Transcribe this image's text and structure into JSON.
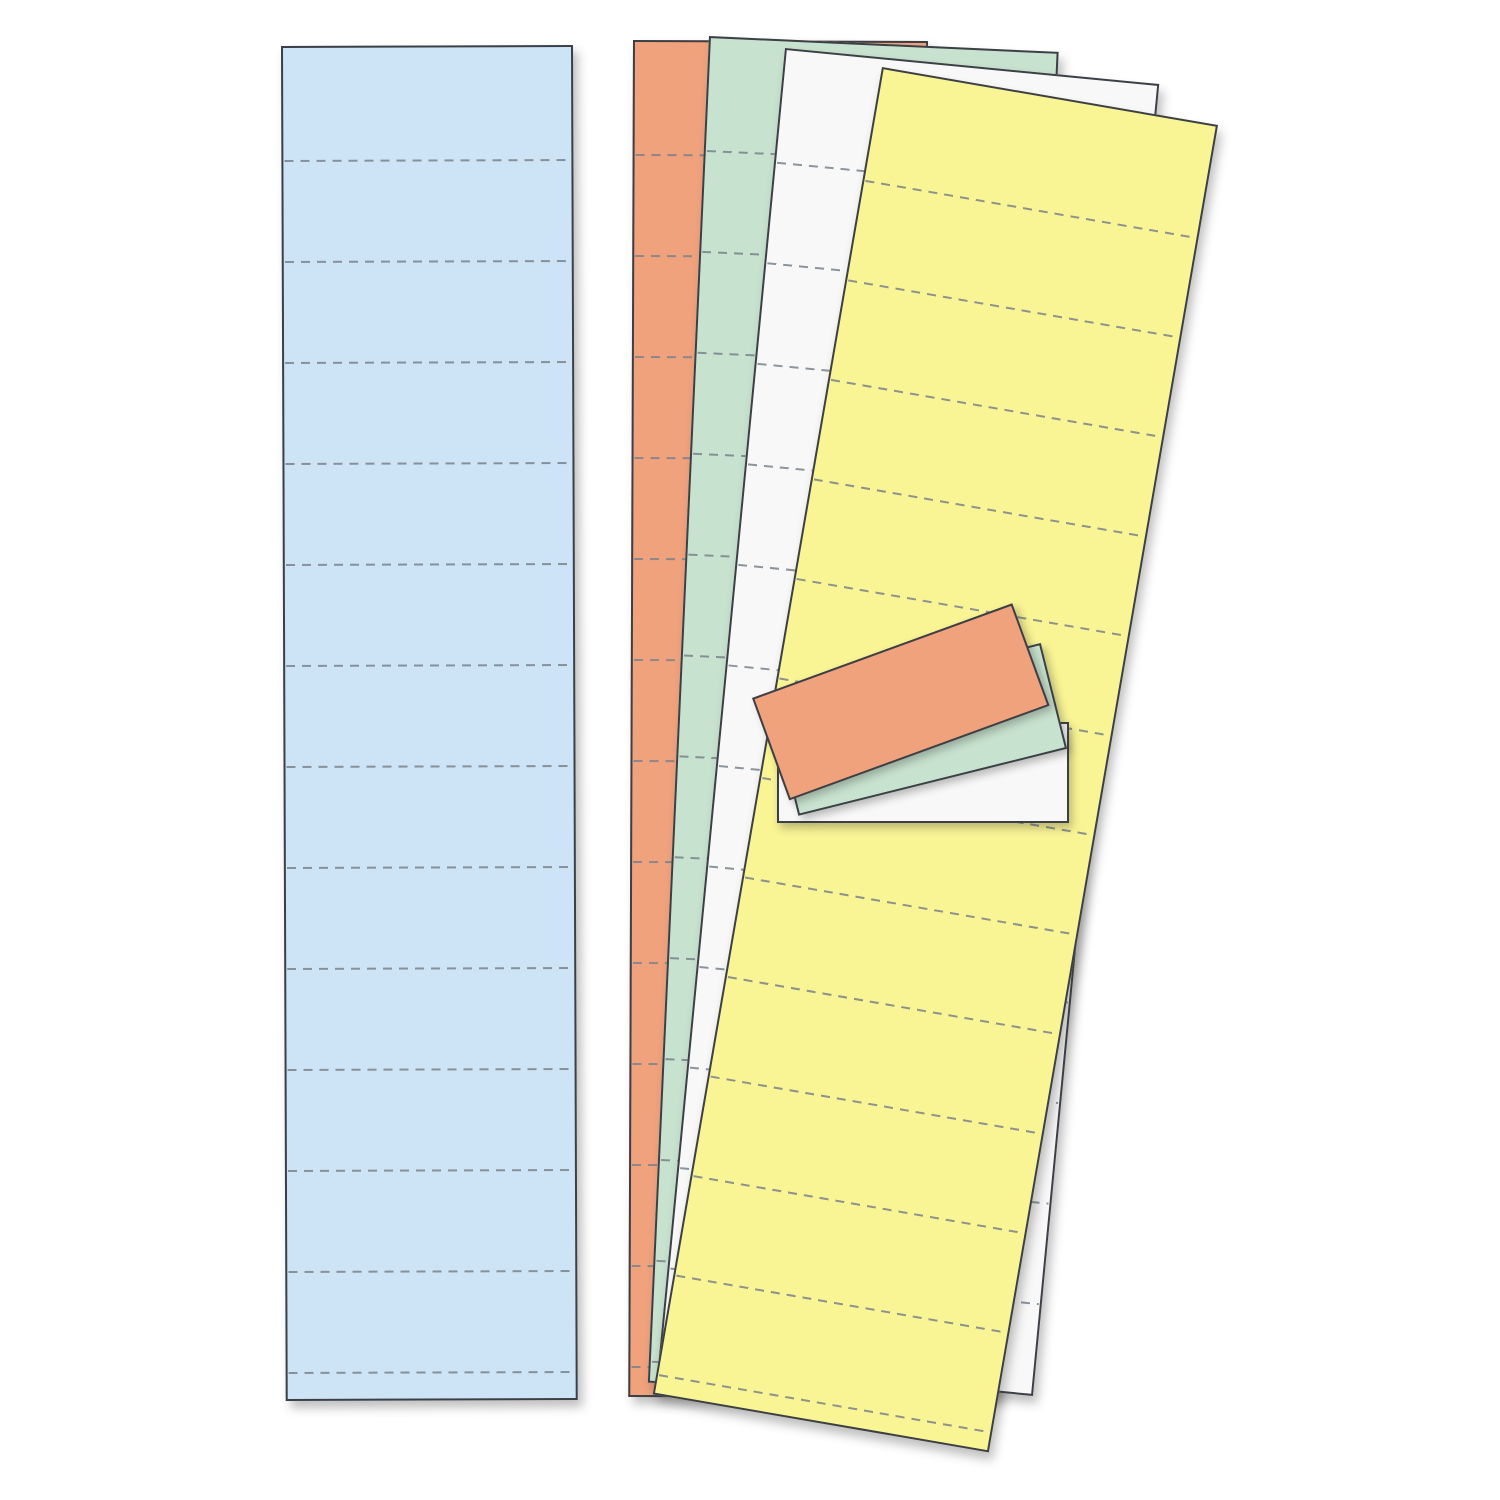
{
  "scene": {
    "type": "product-photo",
    "subject": "Blank perforated data card refill strips in five pastel colors",
    "background_color": "#ffffff",
    "border_color": "#3c4046",
    "perforation_color": "#79828c",
    "perforation_dash_px": 9,
    "perforation_gap_px": 7,
    "strip_shadow": "5px 7px 10px rgba(45,45,45,0.30)",
    "card_shadow": "3px 5px 8px rgba(45,45,45,0.30)"
  },
  "strips": [
    {
      "id": "blue-strip",
      "color_name": "blue",
      "fill": "#cce4f6",
      "x": 281,
      "y": 46,
      "width": 292,
      "height": 1355,
      "rotation": -0.2,
      "perf_offset": 113,
      "perf_spacing": 101
    },
    {
      "id": "salmon-sheet",
      "color_name": "salmon",
      "fill": "#f0a27d",
      "x": 633,
      "y": 40,
      "width": 295,
      "height": 1357,
      "rotation": 0.2,
      "perf_offset": 113,
      "perf_spacing": 101
    },
    {
      "id": "green-sheet",
      "color_name": "green",
      "fill": "#c7e2ce",
      "x": 709,
      "y": 36,
      "width": 350,
      "height": 1348,
      "rotation": 2.6,
      "perf_offset": 113,
      "perf_spacing": 101
    },
    {
      "id": "white-sheet",
      "color_name": "white",
      "fill": "#f8f8f8",
      "x": 785,
      "y": 48,
      "width": 376,
      "height": 1318,
      "rotation": 5.5,
      "perf_offset": 113,
      "perf_spacing": 101
    },
    {
      "id": "yellow-sheet",
      "color_name": "yellow",
      "fill": "#f9f494",
      "x": 882,
      "y": 67,
      "width": 341,
      "height": 1347,
      "rotation": 9.8,
      "perf_offset": 113,
      "perf_spacing": 101
    }
  ],
  "cards": [
    {
      "id": "white-card",
      "color_name": "white",
      "fill": "#f8f8f8",
      "x": 777,
      "y": 722,
      "width": 292,
      "height": 101,
      "rotation": 0
    },
    {
      "id": "green-card",
      "color_name": "green",
      "fill": "#c7e2ce",
      "x": 772,
      "y": 710,
      "width": 277,
      "height": 109,
      "rotation": -14
    },
    {
      "id": "salmon-card",
      "color_name": "salmon",
      "fill": "#f0a27d",
      "x": 752,
      "y": 698,
      "width": 277,
      "height": 109,
      "rotation": -20
    }
  ]
}
